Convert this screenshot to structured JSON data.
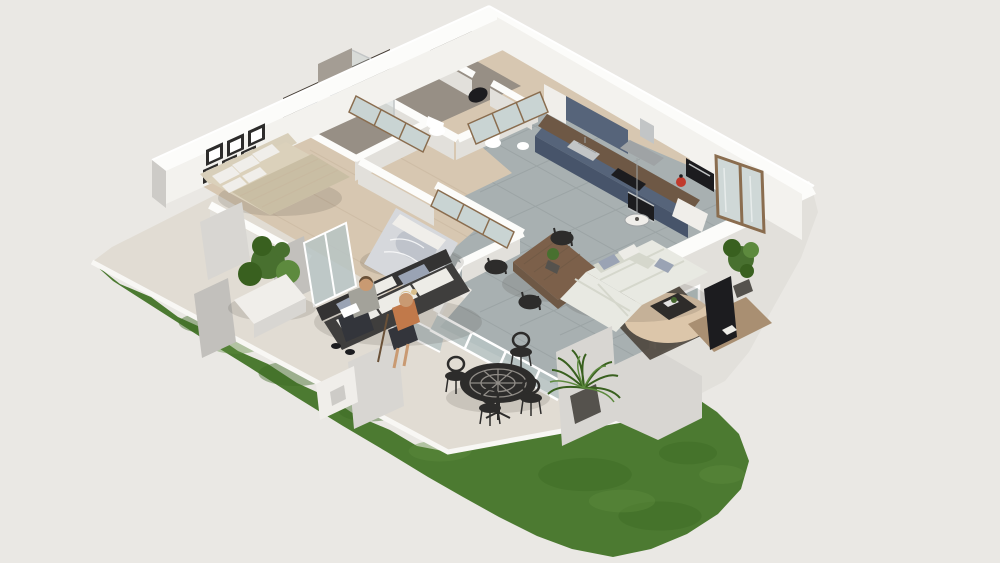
{
  "image_type": "3D rendered isometric floor plan (dollhouse cutaway) of a one-storey apartment with garden terrace",
  "people": [
    {
      "id": "man-reading",
      "description": "man in gray shirt and dark trousers seated on outdoor sofa reading"
    },
    {
      "id": "woman-seated",
      "description": "blonde woman in orange top and dark skirt seated on outdoor sofa holding a cane"
    }
  ],
  "rooms": [
    {
      "name": "bedroom-1",
      "floor": "light wood",
      "items": [
        "double bed with beige bedding",
        "upholstered headboard",
        "framed wall pictures",
        "mirrored wardrobe",
        "glazed door to terrace"
      ]
    },
    {
      "name": "bathroom",
      "floor": "dark tile",
      "items": [
        "dark mosaic feature walls",
        "concrete shower panel",
        "navy vanity with white basin"
      ]
    },
    {
      "name": "wc-1",
      "floor": "tile",
      "items": [
        "toilet",
        "round dark wall mirror"
      ]
    },
    {
      "name": "wc-2",
      "floor": "tile",
      "items": [
        "toilet",
        "washbasin",
        "round dark wall mirror"
      ]
    },
    {
      "name": "hallway",
      "floor": "light wood",
      "items": [
        "mirrored closet"
      ]
    },
    {
      "name": "bedroom-2",
      "floor": "light wood",
      "items": [
        "double bed with gray bedding",
        "mirrored sliding wardrobe",
        "window to terrace"
      ]
    },
    {
      "name": "kitchen",
      "floor": "gray tile",
      "items": [
        "navy blue base and wall cabinets",
        "dark wood countertop",
        "stainless sink",
        "black hob",
        "range hood",
        "built-in oven",
        "microwave",
        "red fire extinguisher",
        "pendant lamp"
      ]
    },
    {
      "name": "living-dining",
      "floor": "gray tile",
      "items": [
        "wooden dining table",
        "black dining chairs",
        "plant centerpiece",
        "white corner sofa with cushions",
        "round beige rug",
        "dark area rug",
        "black coffee table",
        "tv on wooden sideboard",
        "tall potted plant",
        "glazed entry door",
        "sliding glass doors to terrace",
        "corner window"
      ]
    }
  ],
  "exterior": {
    "name": "terrace-garden",
    "items": [
      "cream paved terrace",
      "green lawn",
      "white planter with shrub",
      "low concrete walls and pillars",
      "dark outdoor sofa with white cushions",
      "black cast-iron bistro table",
      "black bistro chairs",
      "potted palm plant",
      "white utility box"
    ]
  },
  "palette": {
    "background": "#eae8e4",
    "wall_top": "#fcfcfa",
    "wall_face": "#f3f2ee",
    "wall_face_shade": "#e2e0db",
    "wall_gray": "#cdcbc7",
    "concrete": "#c2c0bc",
    "concrete_light": "#d8d6d2",
    "grass": "#4c7a31",
    "grass_dark": "#3e6a26",
    "grass_light": "#5e8c3e",
    "terrace": "#e1dcd3",
    "terrace_border": "#f8f7f4",
    "tile": "#a8b0b1",
    "tile_line": "#98a1a3",
    "wood_floor": "#d7c7b1",
    "wood_floor_dark": "#c8b69e",
    "bath_floor": "#978f85",
    "mosaic": "#453d35",
    "shower_panel": "#a49d94",
    "navy": "#56647a",
    "navy_dark": "#47546a",
    "counter_wood": "#6e5845",
    "steel": "#c2c5c6",
    "steel_dark": "#9fa3a5",
    "glass": "#b7c4c4",
    "glass_light": "#cfd8d7",
    "door_wood": "#8a6d4f",
    "mirror": "#c9d4d3",
    "bed_beige": "#c9bea4",
    "bed_beige_light": "#dbd1bb",
    "headboard": "#d8cfba",
    "bed_gray": "#d6d8dc",
    "bed_gray_shadow": "#bfc3cb",
    "sofa": "#e8e9e2",
    "sofa_shade": "#d5d7cc",
    "pillow_gray": "#9aa3b4",
    "rug_round": "#dcc6aa",
    "rug_dark": "#4e473e",
    "table_wood": "#7c604a",
    "sideboard": "#a98f72",
    "black": "#2d2c2b",
    "tv_black": "#1c1c1f",
    "plant": "#48702f",
    "plant_dark": "#39601f",
    "plant_light": "#5d8a3e",
    "pot_dark": "#55524d",
    "planter_white": "#f0eeea",
    "red": "#c13a2c",
    "skin": "#c99a72",
    "hair_blond": "#d8bf8d",
    "hair_brown": "#6a5138",
    "shirt_gray": "#a3a29a",
    "pants_dark": "#33353b",
    "top_orange": "#c1794a",
    "outdoor_frame": "#3f3e3d",
    "outdoor_frame_dark": "#343333",
    "cushion_white": "#edece7",
    "shadow": "rgba(60,52,42,0.14)",
    "white": "#ffffff"
  }
}
